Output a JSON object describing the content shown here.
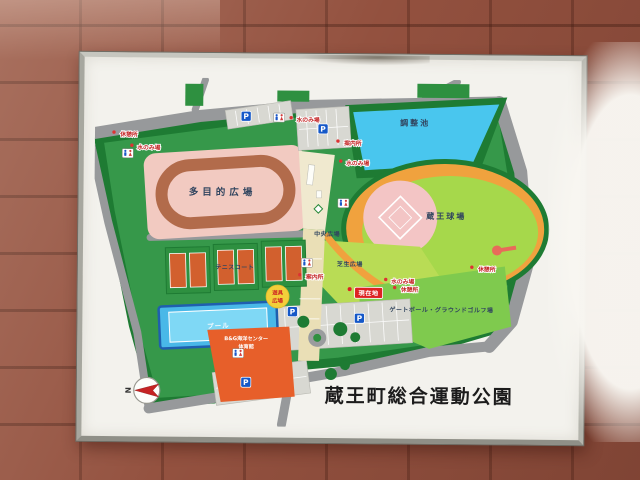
{
  "sign": {
    "title": "蔵王町総合運動公園",
    "compass_north": "N"
  },
  "labels": {
    "multipurpose_field": "多目的広場",
    "pond": "調整池",
    "stadium": "蔵王球場",
    "tennis_courts": "テニスコート",
    "pool": "プール",
    "lawn_plaza": "芝生広場",
    "central_plaza": "中央広場",
    "gateball": "ゲートボール・グラウンドゴルフ場",
    "playground_line1": "遊具",
    "playground_line2": "広場",
    "center_building_line1": "B&G海洋センター",
    "center_building_line2": "体育館",
    "information": "案内所",
    "water_fountain": "水のみ場",
    "rest_area": "休憩所",
    "current_location": "現在地",
    "parking": "P"
  },
  "colors": {
    "wall_brick": "#93513f",
    "sign_face": "#f3f2ed",
    "grass": "#36984a",
    "tree": "#1e7b33",
    "road": "#97999b",
    "pond_blue": "#49c6ee",
    "track_pink": "#f2cac1",
    "track_brown": "#b26b4b",
    "stadium_orange": "#f0a23e",
    "stadium_green": "#a6d84b",
    "infield_pink": "#f3c5c5",
    "tennis_court_orange": "#d2602e",
    "pool_blue": "#7fd8f5",
    "building_orange": "#e75f2a",
    "lawn_green": "#b9dc55",
    "gateball_green": "#7fca4e",
    "walkway_cream": "#eadfb6",
    "badge_red": "#dd2222",
    "parking_blue": "#1558c8"
  }
}
